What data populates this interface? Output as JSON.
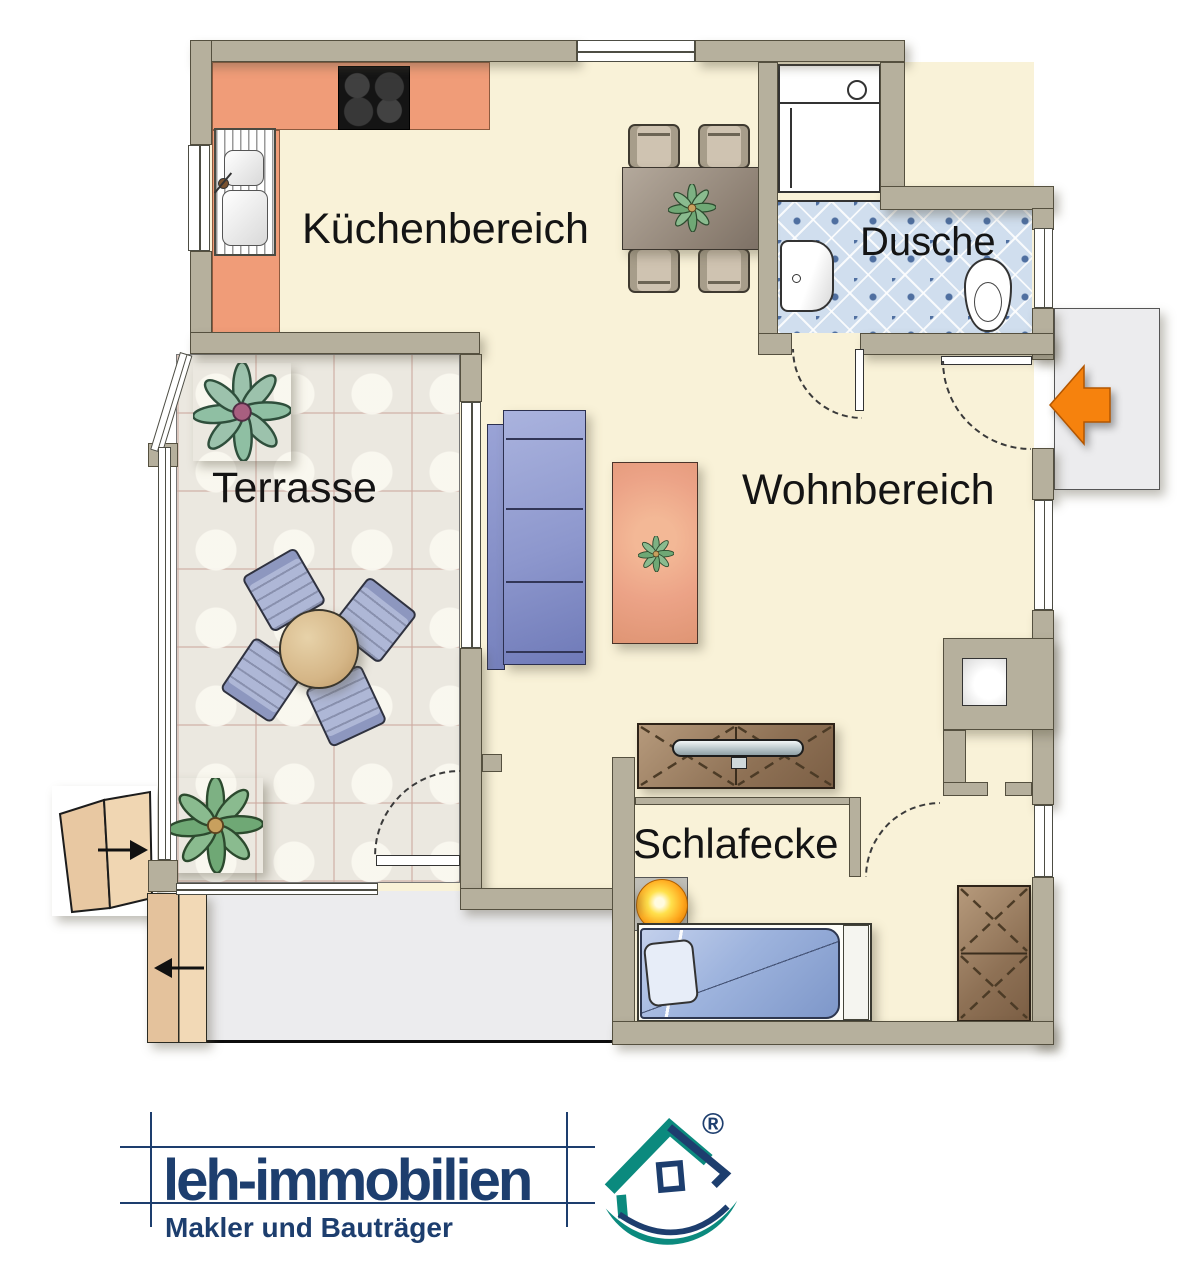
{
  "plan": {
    "labels": {
      "kitchen": "Küchenbereich",
      "shower": "Dusche",
      "terrace": "Terrasse",
      "living": "Wohnbereich",
      "sleeping": "Schlafecke"
    },
    "colors": {
      "wall": "#b6b09d",
      "floor": "#f9f2d8",
      "kitchen_counter": "#f09c78",
      "shower_tile": "#d0deee",
      "terrace_tile": "#ebe8e0",
      "sofa": "#8d97cd",
      "rug": "#eca387",
      "bed": "#9db3dd",
      "wood": "#8e7155",
      "round_table": "#d5b687",
      "dining_table": "#8e8174",
      "lamp": "#ffa81e",
      "entry_arrow": "#f6820d",
      "landing": "#ececee",
      "stairs": "#ecd0ae",
      "plant_green": "#7db183",
      "plant_teal": "#9cc2ac"
    }
  },
  "branding": {
    "name": "leh-immobilien",
    "tagline": "Makler und Bauträger",
    "registered_mark": "®",
    "navy": "#1d3e6e",
    "teal": "#0b8a7e"
  }
}
